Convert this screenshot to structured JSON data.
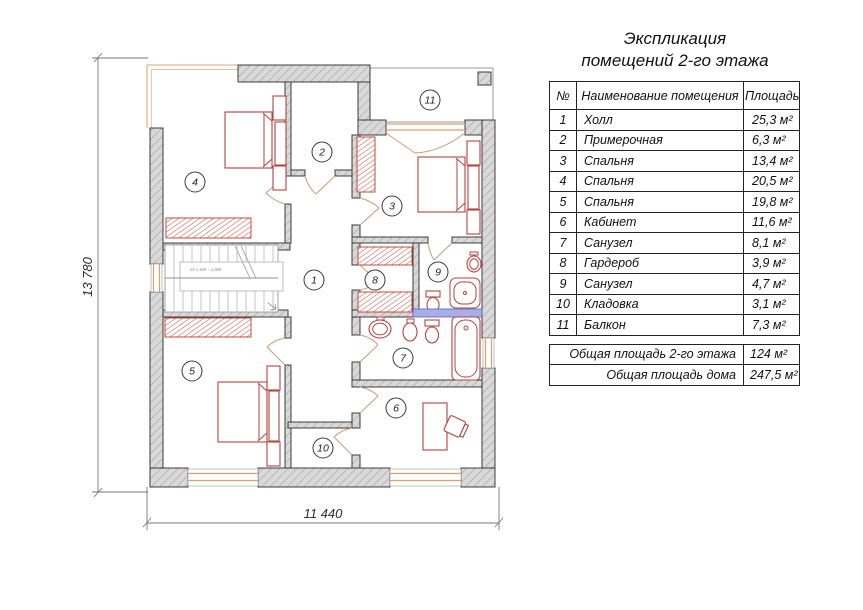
{
  "title": {
    "line1": "Экспликация",
    "line2": "помещений 2-го этажа"
  },
  "table": {
    "headers": {
      "num": "№",
      "name": "Наименование помещения",
      "area": "Площадь"
    },
    "rows": [
      {
        "num": "1",
        "name": "Холл",
        "area": "25,3 м²"
      },
      {
        "num": "2",
        "name": "Примерочная",
        "area": "6,3 м²"
      },
      {
        "num": "3",
        "name": "Спальня",
        "area": "13,4 м²"
      },
      {
        "num": "4",
        "name": "Спальня",
        "area": "20,5 м²"
      },
      {
        "num": "5",
        "name": "Спальня",
        "area": "19,8 м²"
      },
      {
        "num": "6",
        "name": "Кабинет",
        "area": "11,6 м²"
      },
      {
        "num": "7",
        "name": "Санузел",
        "area": "8,1 м²"
      },
      {
        "num": "8",
        "name": "Гардероб",
        "area": "3,9 м²"
      },
      {
        "num": "9",
        "name": "Санузел",
        "area": "4,7 м²"
      },
      {
        "num": "10",
        "name": "Кладовка",
        "area": "3,1 м²"
      },
      {
        "num": "11",
        "name": "Балкон",
        "area": "7,3 м²"
      }
    ],
    "totals": [
      {
        "label": "Общая площадь 2-го этажа",
        "value": "124 м²"
      },
      {
        "label": "Общая площадь дома",
        "value": "247,5 м²"
      }
    ]
  },
  "plan": {
    "room_labels": [
      "1",
      "2",
      "3",
      "4",
      "5",
      "6",
      "7",
      "8",
      "9",
      "10",
      "11"
    ],
    "dim_width": "11 440",
    "dim_height": "13 780",
    "stairs_note": "20 x 180 = 3,600",
    "colors": {
      "wall_fill": "#d9d9d9",
      "wall_hatch": "#a3a3a3",
      "outline": "#3c3c3c",
      "furniture": "#b5433c",
      "window": "#df9d6e",
      "shower_glass": "#9aa0e0"
    }
  }
}
